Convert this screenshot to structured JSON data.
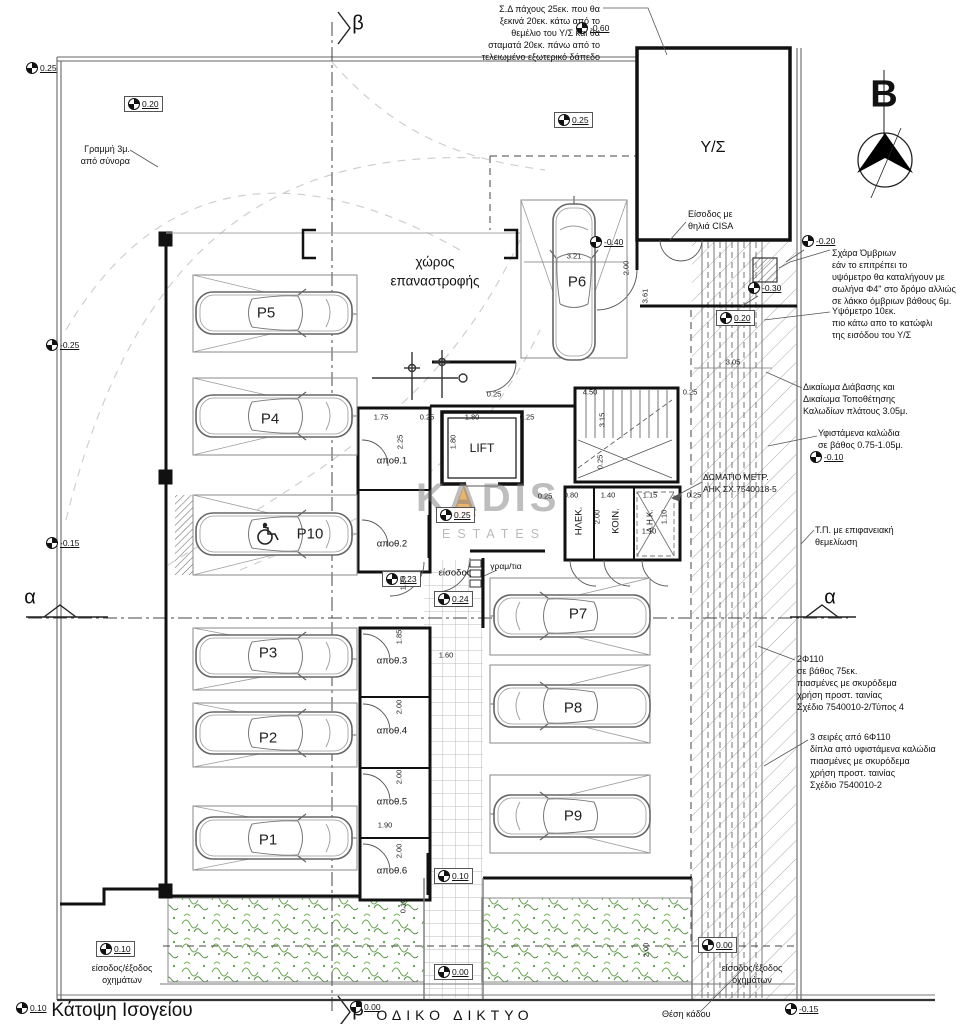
{
  "drawing": {
    "title": "Κάτοψη Ισογείου",
    "road_label": "ΟΔΙΚΟ ΔΙΚΤΥΟ",
    "north_letter": "B"
  },
  "watermark": {
    "name": "KADIS",
    "sub": "ESTATES"
  },
  "sections": {
    "alpha": "α",
    "beta": "β"
  },
  "rooms": {
    "ys": "Υ/Σ",
    "lift": "LIFT",
    "turning1": "χώρος",
    "turning2": "επαναστροφής",
    "apoth1": "αποθ.1",
    "apoth2": "αποθ.2",
    "apoth3": "αποθ.3",
    "apoth4": "αποθ.4",
    "apoth5": "αποθ.5",
    "apoth6": "αποθ.6",
    "elek": "ΗΛΕΚ.",
    "koin": "ΚΟΙΝ.",
    "ahk": "Α.Η.Κ.",
    "entrance": "είσοδος",
    "mailboxes": "γραμ/τια"
  },
  "parking": {
    "p1": "P1",
    "p2": "P2",
    "p3": "P3",
    "p4": "P4",
    "p5": "P5",
    "p6": "P6",
    "p7": "P7",
    "p8": "P8",
    "p9": "P9",
    "p10": "P10"
  },
  "levels": [
    {
      "v": "0.25"
    },
    {
      "v": "0.20"
    },
    {
      "v": "0.25"
    },
    {
      "v": "-0.60"
    },
    {
      "v": "-0.20"
    },
    {
      "v": "-0.40"
    },
    {
      "v": "-0.30"
    },
    {
      "v": "0.20"
    },
    {
      "v": "-0.25"
    },
    {
      "v": "-0.15"
    },
    {
      "v": "0.25"
    },
    {
      "v": "0.23"
    },
    {
      "v": "0.24"
    },
    {
      "v": "-0.10"
    },
    {
      "v": "0.10"
    },
    {
      "v": "0.10"
    },
    {
      "v": "0.00"
    },
    {
      "v": "0.00"
    },
    {
      "v": "0.00"
    },
    {
      "v": "0.10"
    },
    {
      "v": "-0.15"
    }
  ],
  "dims": [
    "3.21",
    "3.61",
    "2.00",
    "3.05",
    "4.50",
    "3.15",
    "0.25",
    "1.75",
    "2.25",
    "1.80",
    "1.80",
    "0.25",
    "0.25",
    "0.25",
    "0.25",
    "0.25",
    "0.80",
    "1.40",
    "1.15",
    "2.00",
    "1.10",
    "1.10",
    "1.60",
    "1.85",
    "2.00",
    "2.00",
    "1.90",
    "2.00",
    "1.25",
    "0.10",
    "2.00",
    "0.25"
  ],
  "annotations": {
    "sd": [
      "Σ.Δ πάχους 25εκ. που  θα",
      "ξεκινά 20εκ. κάτω από το",
      "θεμέλιο του Υ/Σ  και θα",
      "σταματά 20εκ.  πάνω από το",
      "τελειωμένο εξωτερικό δάπεδο"
    ],
    "boundary3m": [
      "Γραμμή 3μ.",
      "από σύνορα"
    ],
    "cisa": [
      "Είσοδος με",
      "θηλιά CISA"
    ],
    "grate": [
      "Σχάρα Όμβριων",
      "εάν το επιτρέπει το",
      "υψόμετρο θα καταλήγουν με",
      "σωλήνα Φ4\" στο δρόμο αλλιώς",
      "σε λάκκο όμβριων βάθους 6μ."
    ],
    "threshold": [
      "Υψόμετρο 10εκ.",
      "πιο κάτω απο το κατώφλι",
      "της εισόδου του Υ/Σ"
    ],
    "right_of_way": [
      "Δικαίωμα Διάβασης και",
      "Δικαίωμα Τοποθέτησης",
      "Καλωδίων πλάτους 3.05μ."
    ],
    "existing_cables": [
      "Υφιστάμενα καλώδια",
      "σε βάθος 0.75-1.05μ."
    ],
    "tp": [
      "Τ.Π. με επιφανειακή",
      "θεμελίωση"
    ],
    "two_f110": [
      "2Φ110",
      "σε βάθος 75εκ.",
      "πιασμένες με σκυρόδεμα",
      "χρήση προστ. ταινίας",
      "Σχέδιο 7540010-2/Τύπος 4"
    ],
    "three_rows": [
      "3 σειρές από 6Φ110",
      "δίπλα από υφιστάμενα καλώδια",
      "πιασμένες με σκυρόδεμα",
      "χρήση προστ. ταινίας",
      "Σχέδιο 7540010-2"
    ],
    "meter_room": [
      "ΔΩΜΑΤΙΟ ΜΕΤΡ.",
      "ΑΗΚ ΣΧ.7540018-5"
    ],
    "veh_left": [
      "είσοδος/έξοδος",
      "οχημάτων"
    ],
    "veh_right": [
      "είσοδος/έξοδος",
      "οχημάτων"
    ],
    "bin": "Θέση κάδου"
  }
}
